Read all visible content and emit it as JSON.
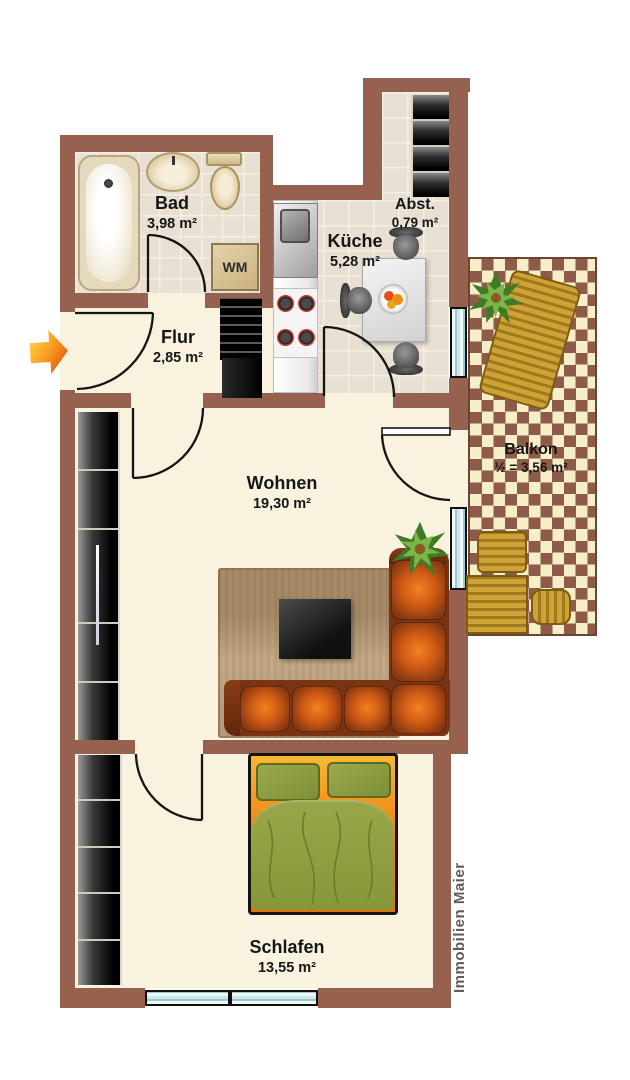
{
  "plan": {
    "branding": "Immobilien Maier",
    "rooms": [
      {
        "id": "bad",
        "name": "Bad",
        "area": "3,98 m²"
      },
      {
        "id": "kueche",
        "name": "Küche",
        "area": "5,28 m²"
      },
      {
        "id": "abst",
        "name": "Abst.",
        "area": "0,79 m²"
      },
      {
        "id": "flur",
        "name": "Flur",
        "area": "2,85 m²"
      },
      {
        "id": "wohnen",
        "name": "Wohnen",
        "area": "19,30 m²"
      },
      {
        "id": "balkon",
        "name": "Balkon",
        "area": "½ = 3,56 m²"
      },
      {
        "id": "schlafen",
        "name": "Schlafen",
        "area": "13,55 m²"
      }
    ],
    "appliances": {
      "washing_machine": "WM"
    },
    "colors": {
      "wall": "#96614f",
      "floor": "#f9f2df",
      "room_tile": "#e8e1d3",
      "balcony_tile_dark": "#8e5a49",
      "balcony_tile_light": "#f6eec6",
      "sofa_leather": "#cf5a14",
      "bed_frame_orange": "#ef8715",
      "bedding_green": "#95a343",
      "entrance_arrow": "#f7941d",
      "branding_text": "#5c5c5c"
    }
  }
}
